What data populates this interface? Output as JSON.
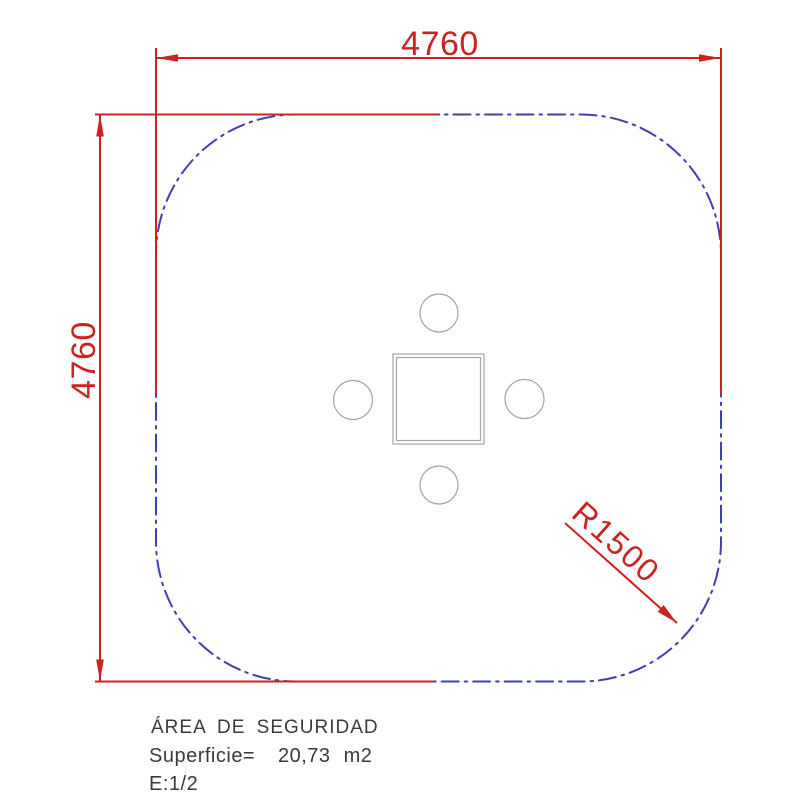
{
  "drawing": {
    "dimensions": {
      "width_mm": "4760",
      "height_mm": "4760",
      "corner_radius": "R1500"
    },
    "notes": {
      "area_title": "ÁREA DE SEGURIDAD",
      "surface_label": "Superficie=",
      "surface_value": "20,73 m2",
      "scale": "E:1/2"
    },
    "colors": {
      "dimension_red": "#cc2222",
      "safety_boundary_blue": "#3f3fb4",
      "equipment_gray": "#a3a3a3",
      "note_text": "#3a3a3a",
      "background": "#ffffff"
    }
  }
}
